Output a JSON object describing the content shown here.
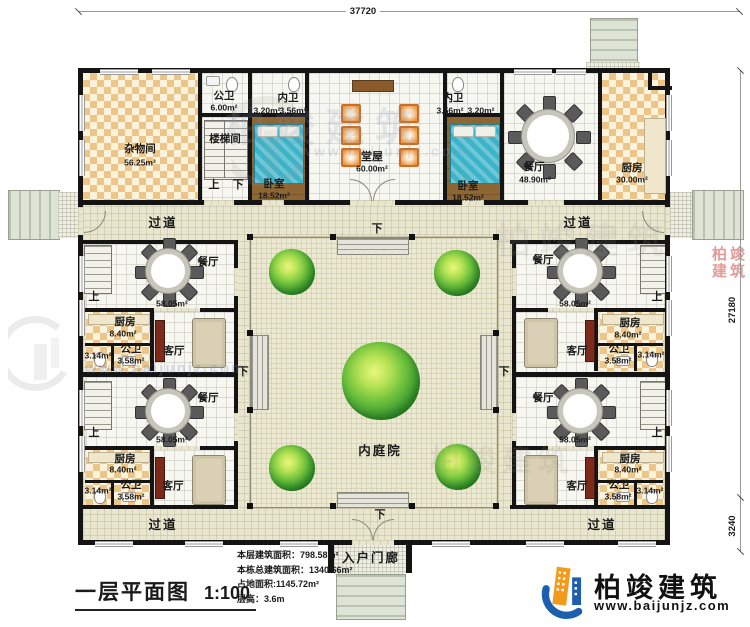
{
  "dimensions": {
    "top_width": "37720",
    "right_main": "27180",
    "right_lower": "3240"
  },
  "title_block": {
    "title": "一层平面图",
    "scale": "1:100"
  },
  "stats": {
    "line1_label": "本层建筑面积：",
    "line1_value": "798.58m²",
    "line2_label": "本栋总建筑面积：",
    "line2_value": "1340.66m²",
    "line3_label": "占地面积:",
    "line3_value": "1145.72m²",
    "line4_label": "层高：",
    "line4_value": "3.6m"
  },
  "brand": {
    "name": "柏竣建筑",
    "website": "www.baijunjz.com"
  },
  "watermarks": {
    "ghost": "柏竣建筑",
    "url": "www.baijunjz.com",
    "stamp": "柏竣建筑"
  },
  "labels": {
    "corridor": "过道",
    "up": "上",
    "down": "下",
    "courtyard": "内庭院",
    "porch": "入户门廊"
  },
  "top_rooms": {
    "storage": {
      "name": "杂物间",
      "area": "56.25m²"
    },
    "public_bath": {
      "name": "公卫",
      "area": "6.00m²"
    },
    "stair_room": {
      "name": "楼梯间"
    },
    "bath_left": {
      "name": "内卫",
      "a1": "3.20m²",
      "a2": "3.56m²"
    },
    "bedroom_left": {
      "name": "卧室",
      "area": "18.52m²"
    },
    "hall": {
      "name": "堂屋",
      "area": "60.00m²"
    },
    "bath_right": {
      "name": "内卫",
      "a1": "3.56m²",
      "a2": "3.20m²"
    },
    "bedroom_right": {
      "name": "卧室",
      "area": "18.52m²"
    },
    "dining": {
      "name": "餐厅",
      "area": "48.90m²"
    },
    "kitchen": {
      "name": "厨房",
      "area": "30.00m²"
    }
  },
  "units": [
    {
      "dining": "餐厅",
      "dining_area": "58.05m²",
      "kitchen": "厨房",
      "kitchen_area": "8.40m²",
      "bath": "公卫",
      "bath_area": "3.58m²",
      "bath_small_area": "3.14m²",
      "living": "客厅"
    },
    {
      "dining": "餐厅",
      "dining_area": "58.05m²",
      "kitchen": "厨房",
      "kitchen_area": "8.40m²",
      "bath": "公卫",
      "bath_area": "3.58m²",
      "bath_small_area": "3.14m²",
      "living": "客厅"
    },
    {
      "dining": "餐厅",
      "dining_area": "58.05m²",
      "kitchen": "厨房",
      "kitchen_area": "8.40m²",
      "bath": "公卫",
      "bath_area": "3.58m²",
      "bath_small_area": "3.14m²",
      "living": "客厅"
    },
    {
      "dining": "餐厅",
      "dining_area": "58.05m²",
      "kitchen": "厨房",
      "kitchen_area": "8.40m²",
      "bath": "公卫",
      "bath_area": "3.58m²",
      "bath_small_area": "3.14m²",
      "living": "客厅"
    }
  ]
}
